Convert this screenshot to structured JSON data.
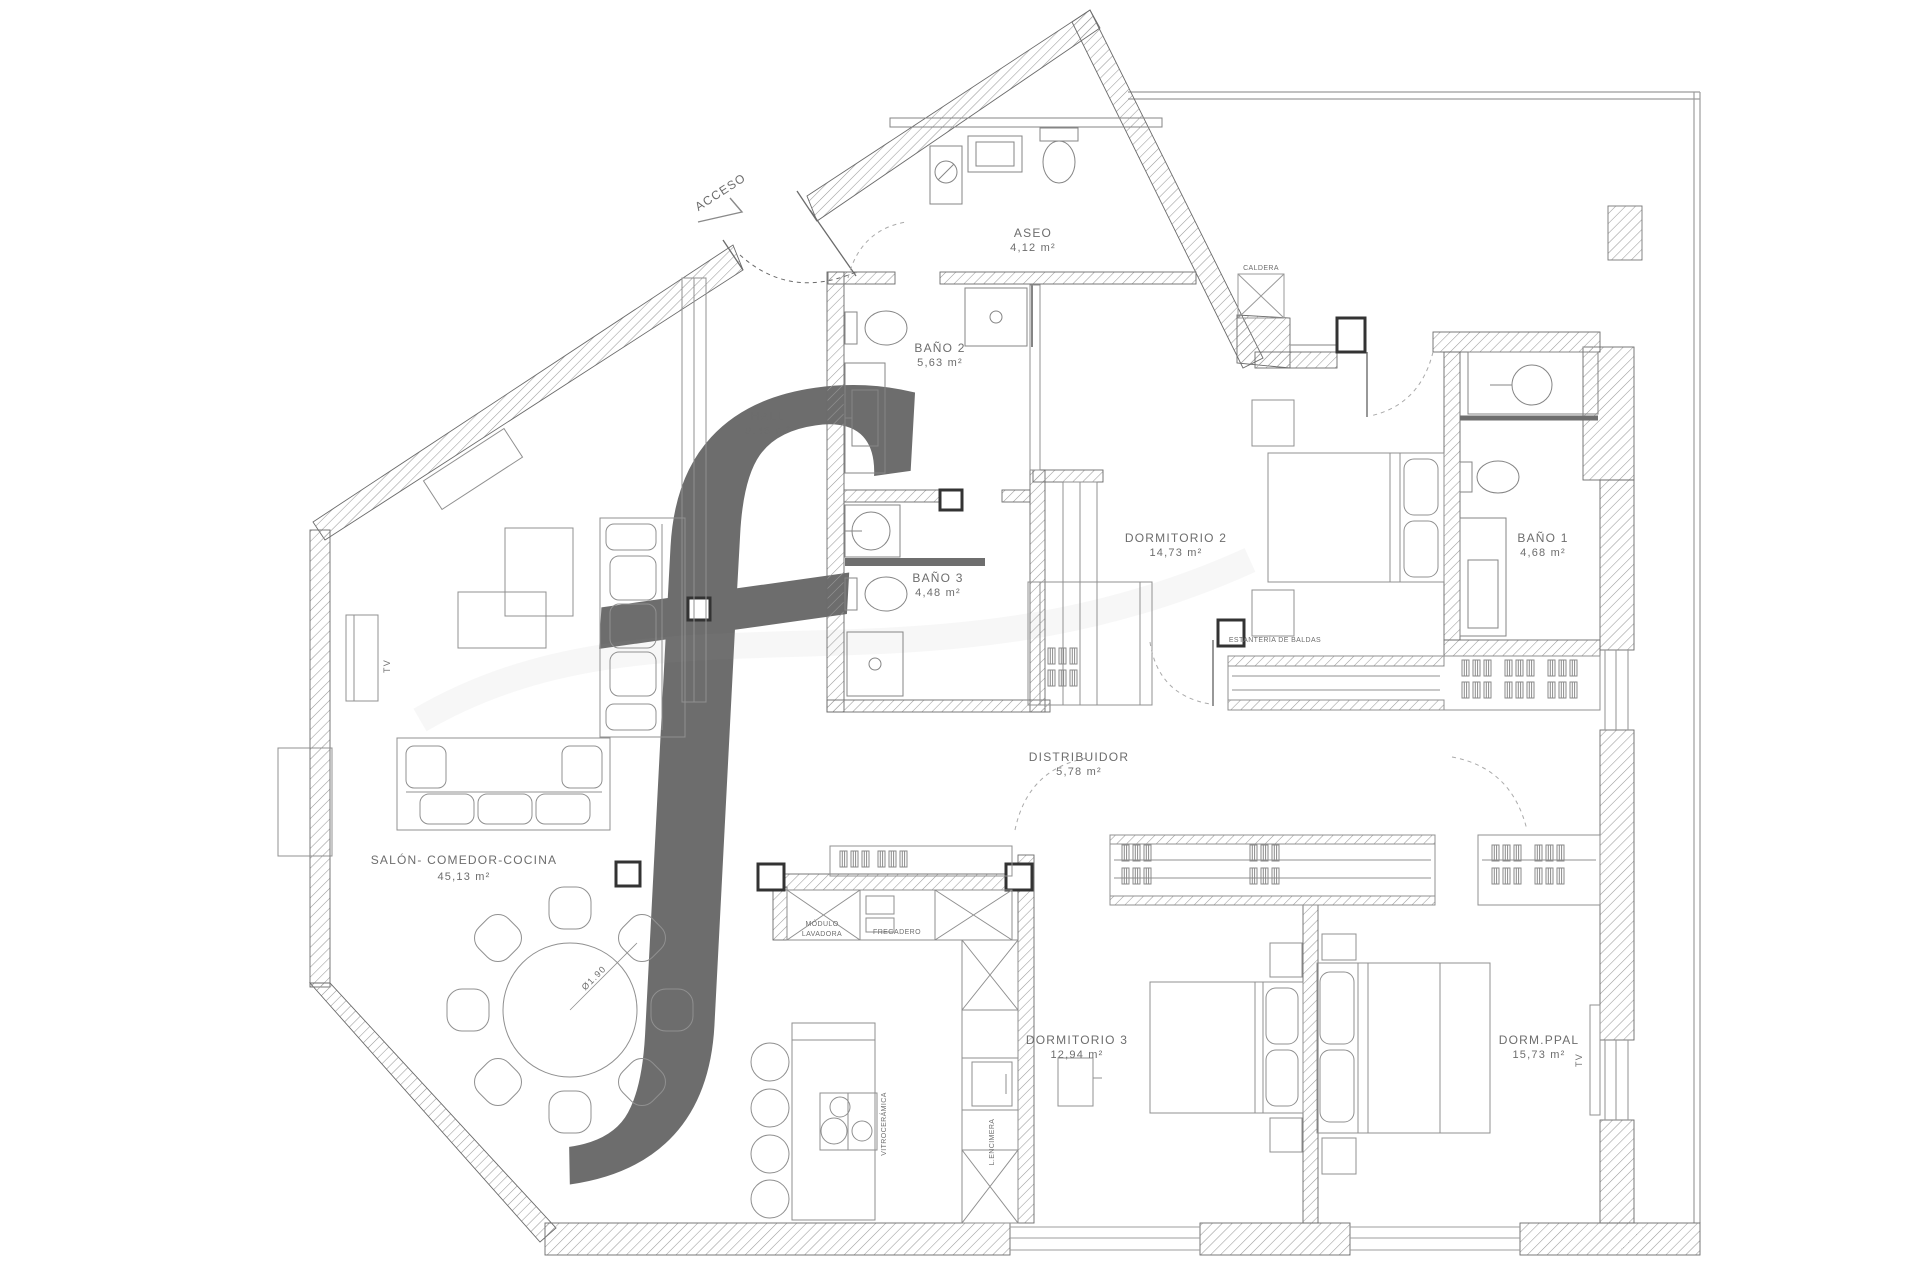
{
  "plan": {
    "access_label": "ACCESO",
    "watermark_letter": "f",
    "rooms": [
      {
        "id": "hall",
        "name": "HALL",
        "area": "9,45 m²"
      },
      {
        "id": "aseo",
        "name": "ASEO",
        "area": "4,12 m²"
      },
      {
        "id": "bano2",
        "name": "BAÑO 2",
        "area": "5,63 m²"
      },
      {
        "id": "bano3",
        "name": "BAÑO 3",
        "area": "4,48 m²"
      },
      {
        "id": "dormitorio2",
        "name": "DORMITORIO 2",
        "area": "14,73 m²"
      },
      {
        "id": "bano1",
        "name": "BAÑO 1",
        "area": "4,68 m²"
      },
      {
        "id": "distribuidor",
        "name": "DISTRIBUIDOR",
        "area": "5,78 m²"
      },
      {
        "id": "salon",
        "name": "SALÓN- COMEDOR-COCINA",
        "area": "45,13 m²"
      },
      {
        "id": "dormitorio3",
        "name": "DORMITORIO 3",
        "area": "12,94 m²"
      },
      {
        "id": "dormppal",
        "name": "DORM.PPAL",
        "area": "15,73 m²"
      }
    ],
    "annotations": {
      "caldera": "CALDERA",
      "estanteria": "ESTANTERÍA DE BALDAS",
      "fregadero": "FREGADERO",
      "modulo_l1": "MÓDULO",
      "modulo_l2": "LAVADORA",
      "vitroceramica": "VITROCERÁMICA",
      "encimera": "L.ENCIMERA",
      "tv": "TV",
      "table_diameter": "Ø1.90"
    }
  }
}
